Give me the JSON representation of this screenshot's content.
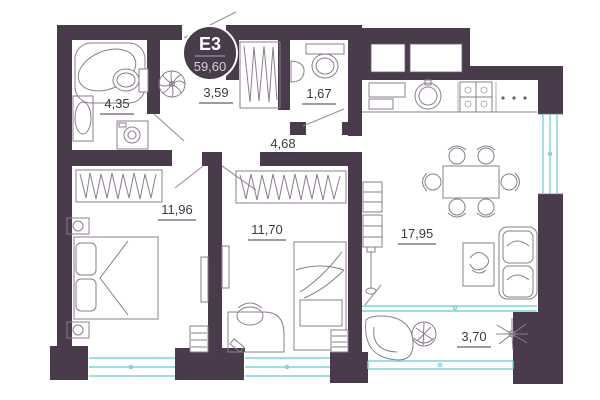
{
  "badge": {
    "code": "E3",
    "total_area": "59,60"
  },
  "rooms": {
    "bathroom": {
      "area": "4,35"
    },
    "corridor": {
      "area": "3,59"
    },
    "wc": {
      "area": "1,67"
    },
    "hallway": {
      "area": "4,68"
    },
    "bedroom_1": {
      "area": "11,96"
    },
    "bedroom_2": {
      "area": "11,70"
    },
    "kitchen_living": {
      "area": "17,95"
    },
    "balcony": {
      "area": "3,70"
    }
  },
  "colors": {
    "wall": "#493a4c",
    "glazing": "#7fd3d8",
    "furniture_line": "#8b7c8e",
    "label_text": "#3e3744"
  }
}
